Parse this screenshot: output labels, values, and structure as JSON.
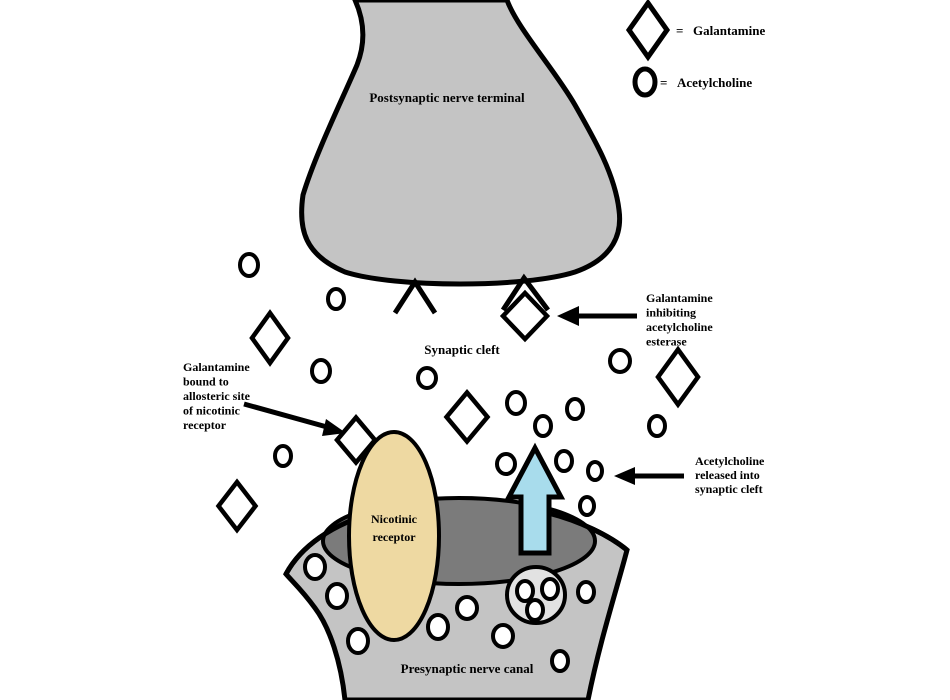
{
  "legend": {
    "items": [
      {
        "icon": "galantamine-diamond-icon",
        "eq": "=",
        "label": "Galantamine"
      },
      {
        "icon": "acetylcholine-oval-icon",
        "eq": "=",
        "label": "Acetylcholine"
      }
    ]
  },
  "regions": {
    "postsynaptic_label": "Postsynaptic nerve terminal",
    "synaptic_cleft_label": "Synaptic cleft",
    "presynaptic_label": "Presynaptic nerve canal",
    "nicotinic_receptor_lines": [
      "Nicotinic",
      "receptor"
    ]
  },
  "annotations": {
    "galantamine_inhibiting": {
      "lines": [
        "Galantamine",
        "inhibiting",
        "acetylcholine",
        "esterase"
      ]
    },
    "galantamine_allosteric": {
      "lines": [
        "Galantamine",
        "bound to",
        "allosteric site",
        "of nicotinic",
        "receptor"
      ]
    },
    "acetylcholine_released": {
      "lines": [
        "Acetylcholine",
        "released into",
        "synaptic cleft"
      ]
    }
  },
  "colors": {
    "membrane_gray": "#c4c4c4",
    "dense_zone_gray": "#7b7b7b",
    "vesicle_gray": "#e2e2e2",
    "receptor_tan": "#eed9a2",
    "arrow_blue": "#a8dcec",
    "outline_black": "#000000",
    "molecule_white": "#ffffff",
    "background": "#ffffff"
  },
  "molecules": {
    "diamonds": [
      {
        "x": 270,
        "y": 338,
        "w": 36,
        "h": 50
      },
      {
        "x": 237,
        "y": 506,
        "w": 37,
        "h": 48
      },
      {
        "x": 467,
        "y": 417,
        "w": 41,
        "h": 49
      },
      {
        "x": 525,
        "y": 316,
        "w": 44,
        "h": 46
      },
      {
        "x": 678,
        "y": 377,
        "w": 40,
        "h": 55
      }
    ],
    "diamonds_behind": [
      {
        "x": 356,
        "y": 440,
        "w": 38,
        "h": 45
      }
    ],
    "ovals": [
      {
        "x": 249,
        "y": 265,
        "rx": 9,
        "ry": 11
      },
      {
        "x": 336,
        "y": 299,
        "rx": 8,
        "ry": 10
      },
      {
        "x": 321,
        "y": 371,
        "rx": 9,
        "ry": 11
      },
      {
        "x": 427,
        "y": 378,
        "rx": 9,
        "ry": 10
      },
      {
        "x": 283,
        "y": 456,
        "rx": 8,
        "ry": 10
      },
      {
        "x": 620,
        "y": 361,
        "rx": 10,
        "ry": 11
      },
      {
        "x": 516,
        "y": 403,
        "rx": 9,
        "ry": 11
      },
      {
        "x": 575,
        "y": 409,
        "rx": 8,
        "ry": 10
      },
      {
        "x": 543,
        "y": 426,
        "rx": 8,
        "ry": 10
      },
      {
        "x": 657,
        "y": 426,
        "rx": 8,
        "ry": 10
      },
      {
        "x": 506,
        "y": 464,
        "rx": 9,
        "ry": 10
      },
      {
        "x": 564,
        "y": 461,
        "rx": 8,
        "ry": 10
      },
      {
        "x": 595,
        "y": 471,
        "rx": 7,
        "ry": 9
      },
      {
        "x": 587,
        "y": 506,
        "rx": 7,
        "ry": 9
      },
      {
        "x": 315,
        "y": 567,
        "rx": 10,
        "ry": 12
      },
      {
        "x": 337,
        "y": 596,
        "rx": 10,
        "ry": 12
      },
      {
        "x": 358,
        "y": 641,
        "rx": 10,
        "ry": 12
      },
      {
        "x": 438,
        "y": 627,
        "rx": 10,
        "ry": 12
      },
      {
        "x": 467,
        "y": 608,
        "rx": 10,
        "ry": 11
      },
      {
        "x": 503,
        "y": 636,
        "rx": 10,
        "ry": 11
      },
      {
        "x": 586,
        "y": 592,
        "rx": 8,
        "ry": 10
      },
      {
        "x": 560,
        "y": 661,
        "rx": 8,
        "ry": 10
      }
    ],
    "vesicle_ovals": [
      {
        "x": 525,
        "y": 591,
        "rx": 8,
        "ry": 10
      },
      {
        "x": 550,
        "y": 589,
        "rx": 8,
        "ry": 10
      },
      {
        "x": 535,
        "y": 610,
        "rx": 8,
        "ry": 10
      }
    ]
  }
}
